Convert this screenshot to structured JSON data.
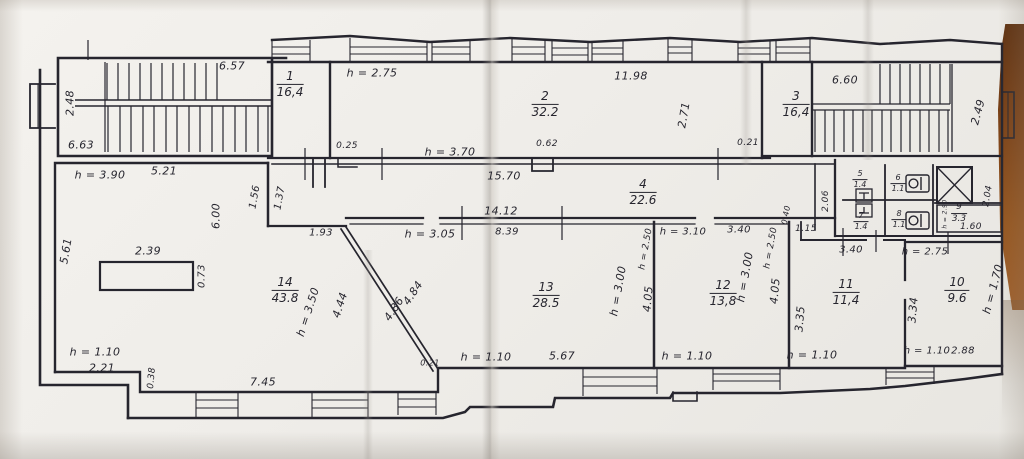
{
  "document": {
    "kind": "scanned floor plan drawing",
    "colors": {
      "paper": "#f0eeea",
      "ink": "#26252e",
      "table_wood": "#8a4a1e"
    }
  },
  "rooms": [
    {
      "number": "1",
      "area": "16,4",
      "x": 290,
      "y": 84
    },
    {
      "number": "2",
      "area": "32.2",
      "x": 545,
      "y": 104
    },
    {
      "number": "3",
      "area": "16,4",
      "x": 796,
      "y": 104
    },
    {
      "number": "4",
      "area": "22.6",
      "x": 643,
      "y": 192
    },
    {
      "number": "5",
      "area": "1.4",
      "x": 860,
      "y": 180,
      "size": 8
    },
    {
      "number": "6",
      "area": "1.1",
      "x": 898,
      "y": 184,
      "size": 8
    },
    {
      "number": "7",
      "area": "1.4",
      "x": 861,
      "y": 222,
      "size": 8
    },
    {
      "number": "8",
      "area": "1.1",
      "x": 899,
      "y": 220,
      "size": 8
    },
    {
      "number": "9",
      "area": "3.3",
      "x": 959,
      "y": 214,
      "size": 9
    },
    {
      "number": "10",
      "area": "9.6",
      "x": 957,
      "y": 290
    },
    {
      "number": "11",
      "area": "11,4",
      "x": 846,
      "y": 292
    },
    {
      "number": "12",
      "area": "13,8",
      "x": 723,
      "y": 293
    },
    {
      "number": "13",
      "area": "28.5",
      "x": 546,
      "y": 295
    },
    {
      "number": "14",
      "area": "43.8",
      "x": 285,
      "y": 290
    }
  ],
  "labels": [
    {
      "t": "6.57",
      "x": 232,
      "y": 66
    },
    {
      "t": "2.48",
      "x": 70,
      "y": 103,
      "r": -90
    },
    {
      "t": "6.63",
      "x": 81,
      "y": 145
    },
    {
      "t": "h = 3.90",
      "x": 100,
      "y": 175
    },
    {
      "t": "5.21",
      "x": 164,
      "y": 171
    },
    {
      "t": "h = 2.75",
      "x": 372,
      "y": 73
    },
    {
      "t": "11.98",
      "x": 631,
      "y": 76
    },
    {
      "t": "2.71",
      "x": 684,
      "y": 115,
      "r": -80
    },
    {
      "t": "6.60",
      "x": 845,
      "y": 80
    },
    {
      "t": "2.49",
      "x": 978,
      "y": 112,
      "r": -75
    },
    {
      "t": "0.25",
      "x": 347,
      "y": 146,
      "s": 9
    },
    {
      "t": "h = 3.70",
      "x": 450,
      "y": 152
    },
    {
      "t": "0.62",
      "x": 547,
      "y": 144,
      "s": 9
    },
    {
      "t": "0.21",
      "x": 748,
      "y": 143,
      "s": 9
    },
    {
      "t": "15.70",
      "x": 504,
      "y": 176
    },
    {
      "t": "14.12",
      "x": 501,
      "y": 211
    },
    {
      "t": "1.56",
      "x": 255,
      "y": 197,
      "r": -80,
      "s": 10
    },
    {
      "t": "1.37",
      "x": 280,
      "y": 198,
      "r": -80,
      "s": 10
    },
    {
      "t": "6.00",
      "x": 216,
      "y": 216,
      "r": -90
    },
    {
      "t": "1.93",
      "x": 321,
      "y": 233,
      "s": 10
    },
    {
      "t": "h = 3.05",
      "x": 430,
      "y": 234
    },
    {
      "t": "8.39",
      "x": 507,
      "y": 232,
      "s": 10
    },
    {
      "t": "5.61",
      "x": 66,
      "y": 251,
      "r": -80
    },
    {
      "t": "2.39",
      "x": 148,
      "y": 251
    },
    {
      "t": "0.73",
      "x": 202,
      "y": 276,
      "r": -90,
      "s": 10
    },
    {
      "t": "h = 3.50",
      "x": 308,
      "y": 312,
      "r": -72
    },
    {
      "t": "4.44",
      "x": 340,
      "y": 305,
      "r": -72
    },
    {
      "t": "4.84",
      "x": 413,
      "y": 293,
      "r": -56
    },
    {
      "t": "4.86",
      "x": 394,
      "y": 309,
      "r": -56
    },
    {
      "t": "h = 1.10",
      "x": 95,
      "y": 352
    },
    {
      "t": "2.21",
      "x": 102,
      "y": 368
    },
    {
      "t": "0.38",
      "x": 152,
      "y": 378,
      "r": -85,
      "s": 9
    },
    {
      "t": "7.45",
      "x": 263,
      "y": 382
    },
    {
      "t": "0.21",
      "x": 430,
      "y": 363,
      "s": 8
    },
    {
      "t": "h = 1.10",
      "x": 486,
      "y": 357
    },
    {
      "t": "5.67",
      "x": 562,
      "y": 356
    },
    {
      "t": "h = 3.00",
      "x": 618,
      "y": 291,
      "r": -80
    },
    {
      "t": "4.05",
      "x": 648,
      "y": 299,
      "r": -85
    },
    {
      "t": "h = 2.50",
      "x": 646,
      "y": 249,
      "r": -80,
      "s": 9
    },
    {
      "t": "h = 3.10",
      "x": 683,
      "y": 232,
      "s": 10
    },
    {
      "t": "3.40",
      "x": 739,
      "y": 230,
      "s": 10
    },
    {
      "t": "h = 3.00",
      "x": 745,
      "y": 277,
      "r": -80
    },
    {
      "t": "h = 2.50",
      "x": 771,
      "y": 248,
      "r": -80,
      "s": 9
    },
    {
      "t": "4.05",
      "x": 775,
      "y": 291,
      "r": -85
    },
    {
      "t": "h = 1.10",
      "x": 687,
      "y": 356
    },
    {
      "t": "2.06",
      "x": 826,
      "y": 201,
      "r": -90,
      "s": 9
    },
    {
      "t": "0.40",
      "x": 786,
      "y": 215,
      "r": -80,
      "s": 8
    },
    {
      "t": "1.15",
      "x": 806,
      "y": 229,
      "s": 9
    },
    {
      "t": "3.35",
      "x": 800,
      "y": 319,
      "r": -85
    },
    {
      "t": "3.40",
      "x": 851,
      "y": 250,
      "s": 10
    },
    {
      "t": "h = 1.10",
      "x": 812,
      "y": 355
    },
    {
      "t": "h = 2.75",
      "x": 925,
      "y": 252,
      "s": 10
    },
    {
      "t": "3.34",
      "x": 913,
      "y": 310,
      "r": -85
    },
    {
      "t": "h = 1.70",
      "x": 993,
      "y": 289,
      "r": -75
    },
    {
      "t": "h = 2.90",
      "x": 945,
      "y": 214,
      "r": -90,
      "s": 6
    },
    {
      "t": "2.04",
      "x": 988,
      "y": 196,
      "r": -80,
      "s": 9
    },
    {
      "t": "1.60",
      "x": 971,
      "y": 227,
      "s": 9
    },
    {
      "t": "h = 1.10",
      "x": 927,
      "y": 351,
      "s": 10
    },
    {
      "t": "2.88",
      "x": 963,
      "y": 351,
      "s": 10
    }
  ]
}
